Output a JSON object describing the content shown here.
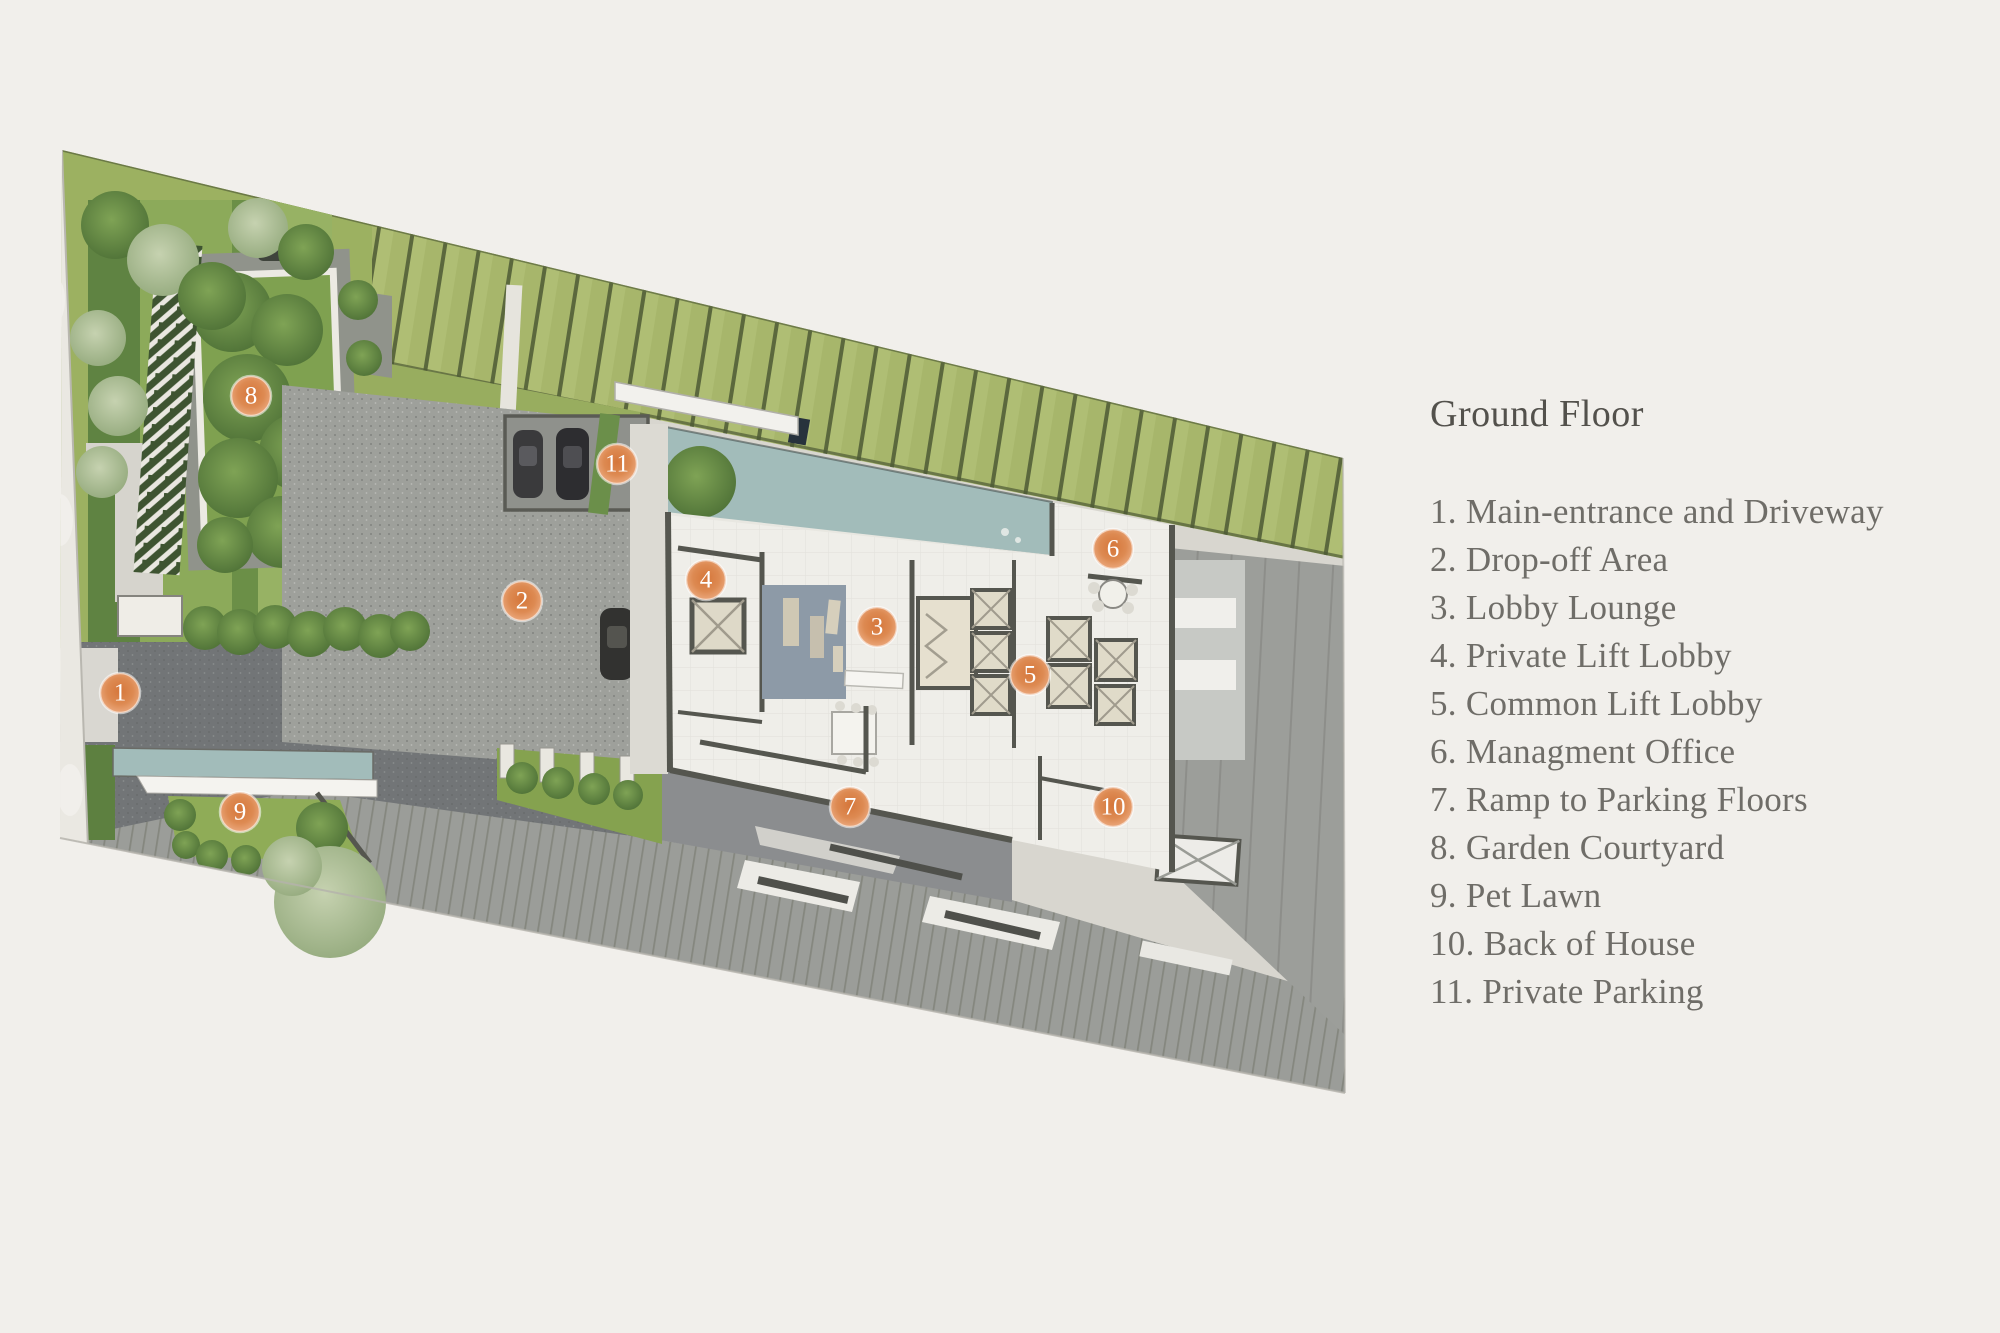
{
  "legend": {
    "title": "Ground Floor"
  },
  "areas": [
    {
      "number": "1",
      "name": "Main-entrance and Driveway",
      "marker_x": 120,
      "marker_y": 693
    },
    {
      "number": "2",
      "name": "Drop-off Area",
      "marker_x": 522,
      "marker_y": 601
    },
    {
      "number": "3",
      "name": "Lobby Lounge",
      "marker_x": 877,
      "marker_y": 627
    },
    {
      "number": "4",
      "name": "Private Lift Lobby",
      "marker_x": 706,
      "marker_y": 580
    },
    {
      "number": "5",
      "name": "Common Lift Lobby",
      "marker_x": 1030,
      "marker_y": 675
    },
    {
      "number": "6",
      "name": "Managment Office",
      "marker_x": 1113,
      "marker_y": 549
    },
    {
      "number": "7",
      "name": "Ramp to Parking Floors",
      "marker_x": 850,
      "marker_y": 807
    },
    {
      "number": "8",
      "name": "Garden Courtyard",
      "marker_x": 251,
      "marker_y": 396
    },
    {
      "number": "9",
      "name": "Pet Lawn",
      "marker_x": 240,
      "marker_y": 812
    },
    {
      "number": "10",
      "name": "Back of House",
      "marker_x": 1113,
      "marker_y": 807
    },
    {
      "number": "11",
      "name": "Private Parking",
      "marker_x": 617,
      "marker_y": 464
    }
  ],
  "plan": {
    "kind": "architectural ground-floor site plan",
    "colors": {
      "background": "#f1efeb",
      "site_base": "#d8d6cf",
      "green_band": "#aebd72",
      "green_band_line": "#5b683d",
      "lawn": "#9db364",
      "hedge_dark": "#4e7238",
      "tree_light": "#b3c49d",
      "water": "#a2bcba",
      "road_dark": "#727577",
      "dropoff_paving": "#9ea09b",
      "ramp": "#8b8d8f",
      "right_yard_gray": "#9c9e9a",
      "floor_white": "#efeee9",
      "wall": "#55564f",
      "marker_orange": "#d9803f",
      "legend_text": "#6f6d68"
    }
  }
}
